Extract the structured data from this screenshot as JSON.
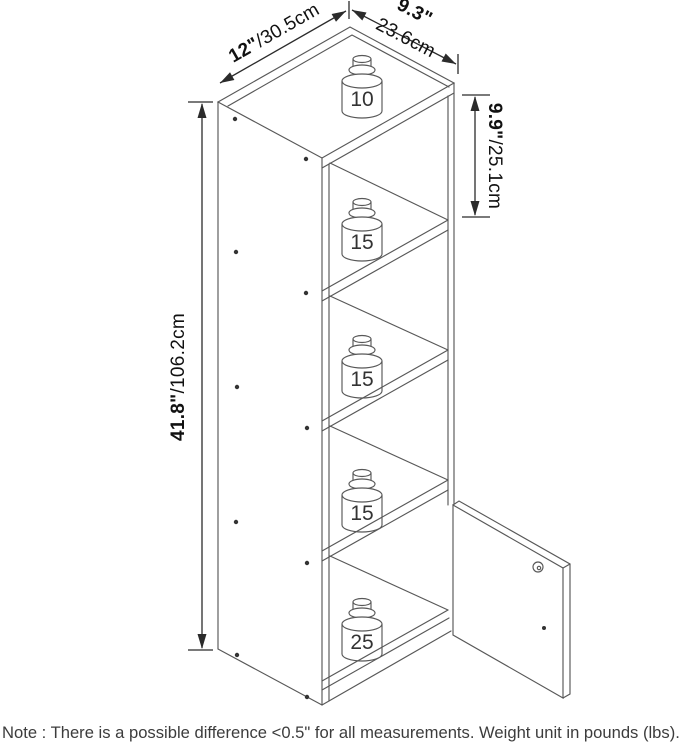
{
  "dimensions": {
    "width_in": "12\"",
    "width_cm": "/30.5cm",
    "depth_in": "9.3\"",
    "depth_cm": "23.6cm",
    "cell_in": "9.9\"",
    "cell_cm": "/25.1cm",
    "height_in": "41.8\"",
    "height_cm": "/106.2cm"
  },
  "weights": {
    "top": "10",
    "cell1": "15",
    "cell2": "15",
    "cell3": "15",
    "bottom": "25"
  },
  "note": "Note : There is a possible difference <0.5\" for all measurements. Weight unit in pounds (lbs).",
  "colors": {
    "line": "#585858",
    "dim_line": "#2b2b2b",
    "label": "#333333",
    "note_text": "#3c3c3c"
  }
}
